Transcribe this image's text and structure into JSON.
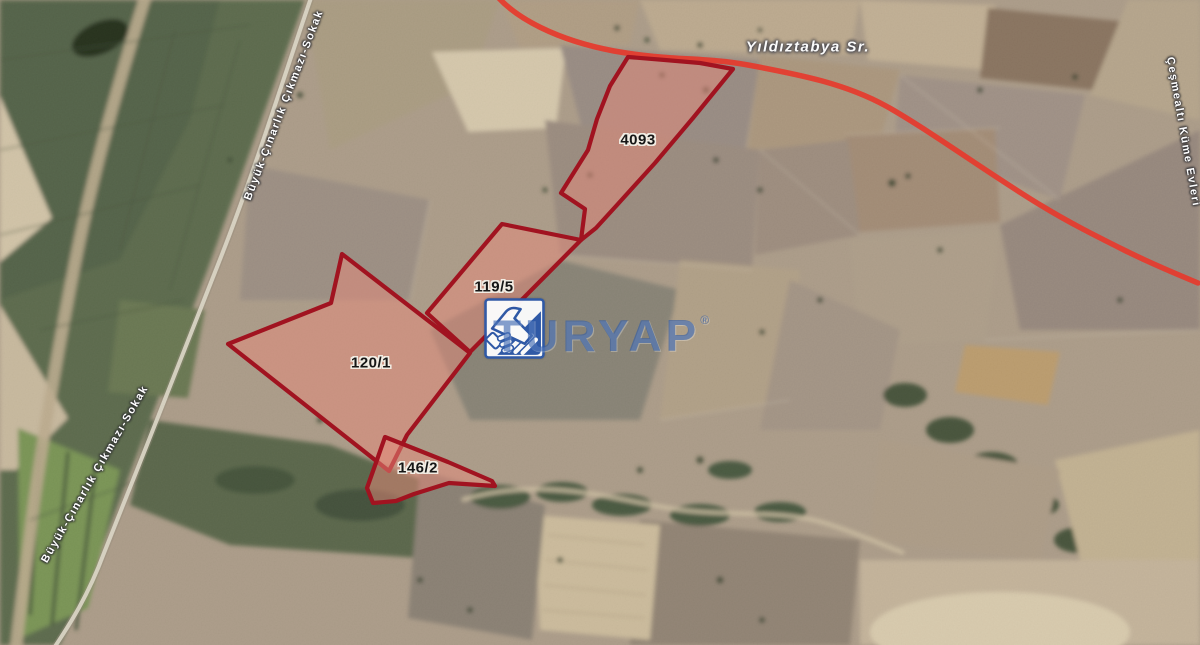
{
  "map": {
    "road_label": "Yıldıztabya Sr.",
    "street_left_label": "Büyük-Çınarlık Çıkmazı-Sokak",
    "street_right_label": "Çeşmealtı Küme Evleri",
    "colors": {
      "parcel_stroke": "#a11320",
      "parcel_fill": "#e8897a",
      "highlighted_road_red": "#e6392c",
      "brand_blue": "#2c58a8"
    },
    "red_road_path": "M 497 -4 C 516 18 556 40 614 51 C 670 61 706 57 748 65 C 802 75 846 84 886 106 C 926 128 992 176 1042 206 C 1070 223 1096 236 1124 250 C 1152 264 1172 272 1198 283",
    "local_road_path": "M 313 -8 C 286 70 256 168 219 262 C 186 346 142 458 104 553 C 88 596 70 624 54 648",
    "parcels": [
      {
        "id": "4093",
        "label": "4093",
        "points": "628,57 665,60 700,63 733,69 693,118 655,163 617,205 596,228 581,240 585,209 561,193 588,150 597,119 610,86"
      },
      {
        "id": "119/5",
        "label": "119/5",
        "points": "502,224 581,240 470,352 427,313"
      },
      {
        "id": "120/1",
        "label": "120/1",
        "points": "342,254 470,353 407,435 389,471 228,344 331,303"
      },
      {
        "id": "146/2",
        "label": "146/2",
        "points": "385,437 448,462 492,481 495,486 449,483 414,494 396,501 373,503 367,488 378,457"
      }
    ]
  },
  "watermark": {
    "brand": "TURYAP",
    "registered": "®"
  }
}
